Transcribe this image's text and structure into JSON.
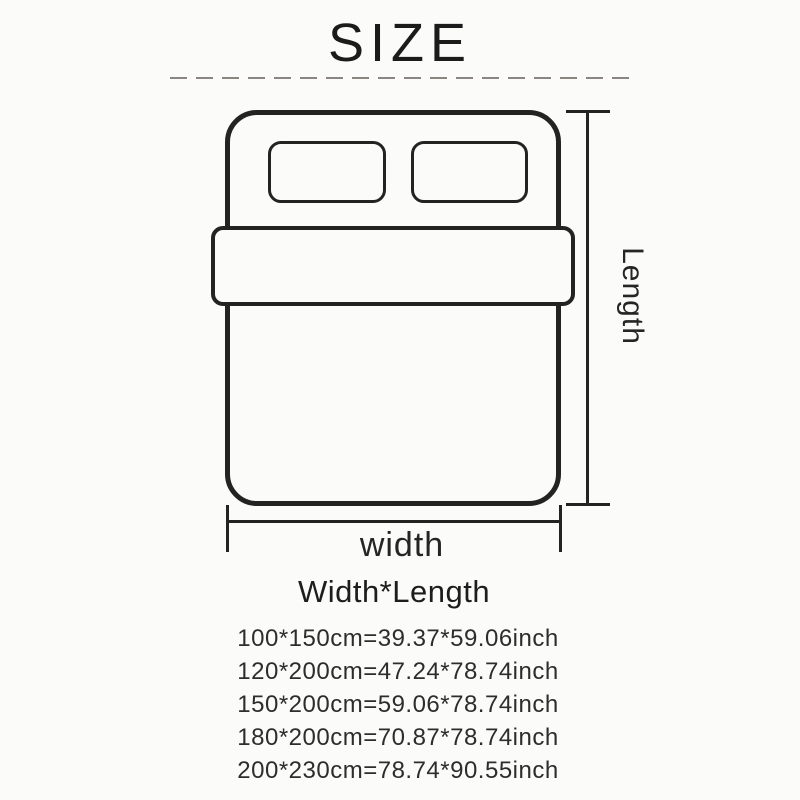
{
  "title": "SIZE",
  "diagram": {
    "length_label": "Length",
    "width_label": "width"
  },
  "size_table": {
    "header": "Width*Length",
    "rows": [
      "100*150cm=39.37*59.06inch",
      "120*200cm=47.24*78.74inch",
      "150*200cm=59.06*78.74inch",
      "180*200cm=70.87*78.74inch",
      "200*230cm=78.74*90.55inch"
    ]
  },
  "colors": {
    "bg": "#fbfbfa",
    "line": "#232323",
    "text": "#2d2d2d",
    "dash": "#8a8580",
    "title": "#1b1b1b"
  }
}
